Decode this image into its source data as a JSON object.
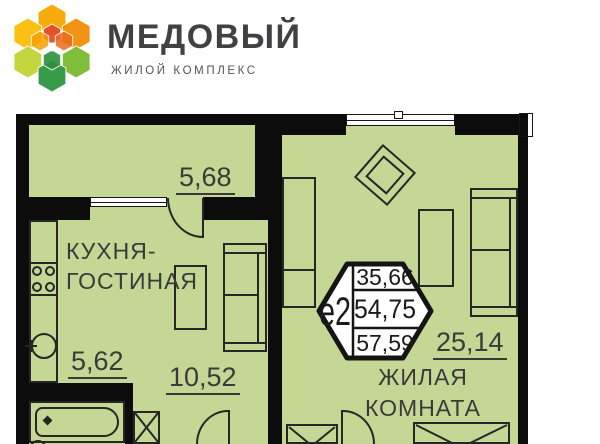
{
  "header": {
    "title": "МЕДОВЫЙ",
    "subtitle": "ЖИЛОЙ КОМПЛЕКС",
    "logo_palette": {
      "orange_top": "#F7A600",
      "orange_ul": "#FABB00",
      "orange_ur": "#F08B00",
      "green_ll": "#BFD22F",
      "green_lr": "#76B82A",
      "green_bottom": "#2E9640",
      "red_inner": "#E04B28",
      "amber_inner": "#F5A000",
      "deep_orange_inner": "#EB6A1A",
      "green_inner": "#2E8F3E"
    }
  },
  "plan": {
    "badge": {
      "label": "е2",
      "rows": [
        "35,66",
        "54,75",
        "57,59"
      ]
    },
    "rooms": {
      "balcony": {
        "area": "5,68"
      },
      "kitchen_living": {
        "name": [
          "КУХНЯ-",
          "ГОСТИНАЯ"
        ],
        "area": "10,52"
      },
      "hall": {
        "area": "5,62"
      },
      "living": {
        "name": [
          "ЖИЛАЯ",
          "КОМНАТА"
        ],
        "area": "25,14"
      }
    },
    "colors": {
      "floor": "#c5d795",
      "wall": "#0c0c0c",
      "outline": "#262626",
      "label_text": "#3a3a3a"
    }
  }
}
